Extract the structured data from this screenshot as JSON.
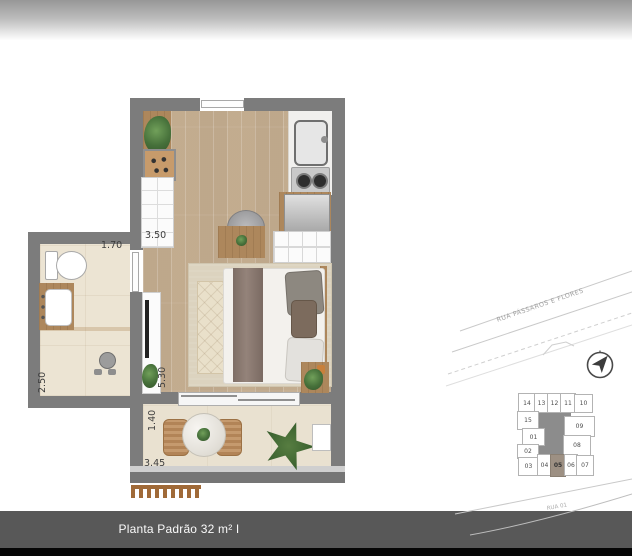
{
  "footer": {
    "title": "Planta Padrão 32 m² I Studio"
  },
  "floor_plan": {
    "labels": {
      "closet_width": "3.50",
      "bathroom_width": "1.70",
      "bathroom_length": "2.50",
      "living_length": "5.30",
      "balcony_depth": "1.40",
      "balcony_width": "3.45"
    }
  },
  "site_plan": {
    "street_top": "RUA PÁSSAROS E FLORES",
    "street_bottom": "RUA 01",
    "highlighted_unit": "05",
    "units": {
      "top": [
        "14",
        "13",
        "12",
        "11",
        "10"
      ],
      "left": [
        "15",
        "01",
        "02"
      ],
      "right": [
        "09",
        "08"
      ],
      "bottom": [
        "03",
        "04",
        "05",
        "06",
        "07"
      ]
    }
  },
  "colors": {
    "wall": "#7c7c7c",
    "footer_bar": "#585858",
    "unit_highlight": "#9d9083",
    "wood_floor": "#c6b094",
    "tile_floor": "#ece4d3"
  }
}
